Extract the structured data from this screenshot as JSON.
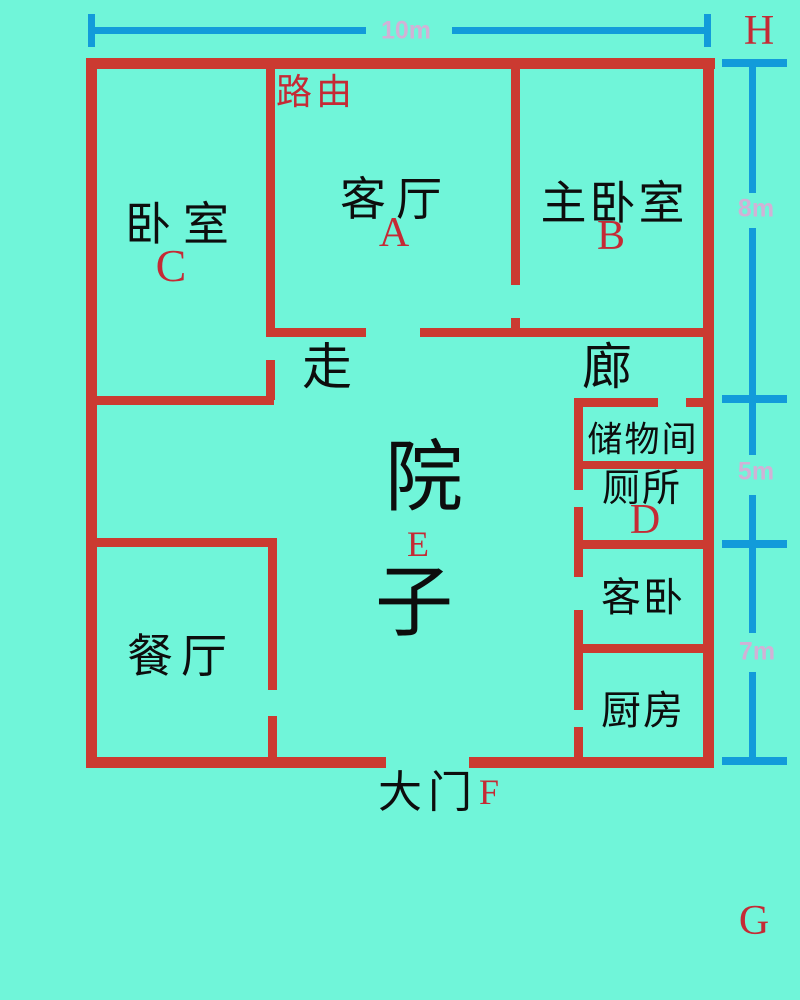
{
  "title": "floor-plan-diagram",
  "colors": {
    "background": "#70f5d9",
    "wall": "#cb3a31",
    "room_text": "#0d0d0d",
    "marker_text": "#c52a35",
    "dimension_line": "#129bda",
    "dimension_text": "#d1b2d6"
  },
  "rooms": [
    {
      "id": "bedroom",
      "label": "卧室",
      "marker": "C"
    },
    {
      "id": "living-room",
      "label": "客厅",
      "marker": "A"
    },
    {
      "id": "master-bedroom",
      "label": "主卧室",
      "marker": "B"
    },
    {
      "id": "corridor",
      "label_first": "走",
      "label_second": "廊"
    },
    {
      "id": "storage-room",
      "label": "储物间"
    },
    {
      "id": "toilet",
      "label": "厕所",
      "marker": "D"
    },
    {
      "id": "guest-bedroom",
      "label": "客卧"
    },
    {
      "id": "kitchen",
      "label": "厨房"
    },
    {
      "id": "dining-room",
      "label": "餐厅"
    },
    {
      "id": "courtyard",
      "label_first": "院",
      "label_second": "子",
      "marker": "E"
    },
    {
      "id": "main-gate",
      "label": "大门",
      "marker": "F"
    }
  ],
  "annotations": {
    "router": "路由",
    "corner_top_right": "H",
    "corner_bottom_right": "G"
  },
  "dimensions": {
    "top": "10m",
    "right_upper": "8m",
    "right_middle": "5m",
    "right_lower": "7m"
  }
}
